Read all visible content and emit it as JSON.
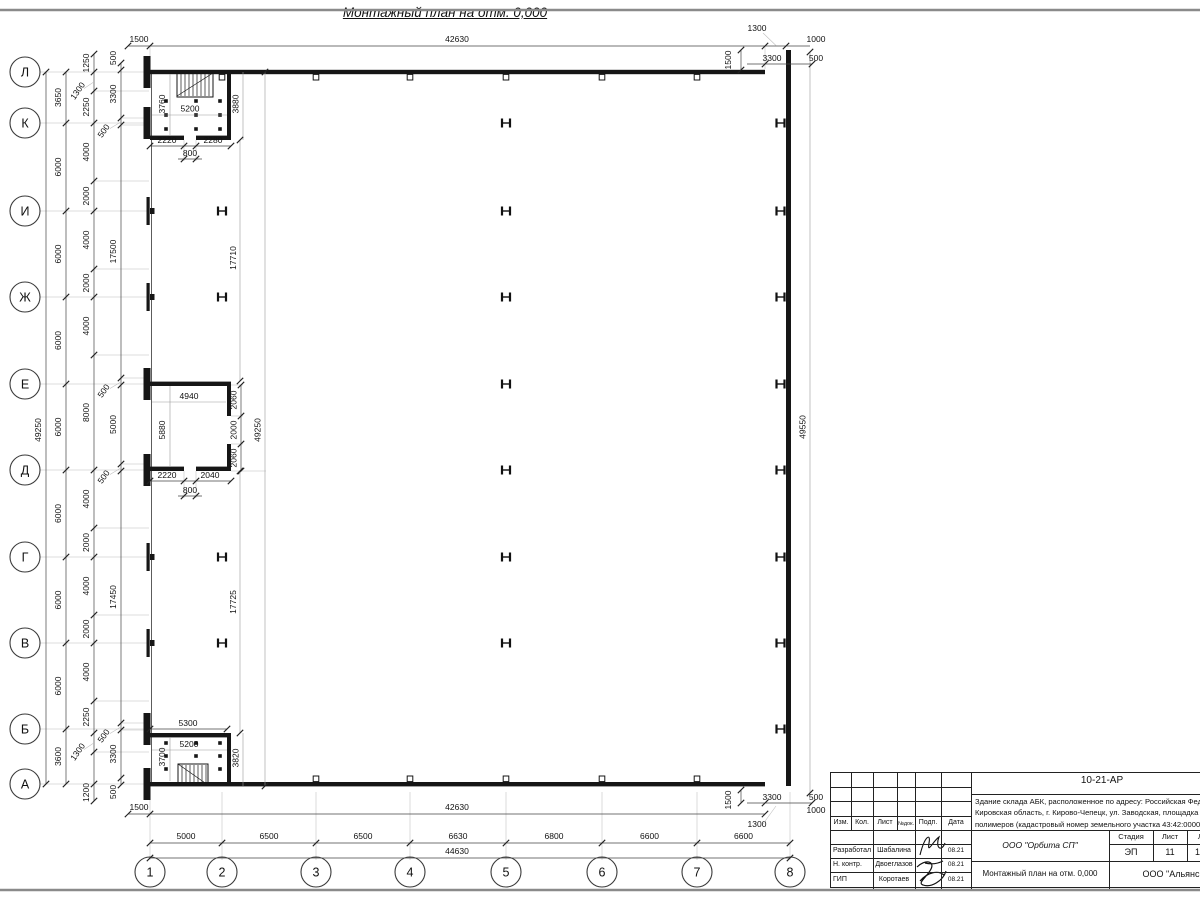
{
  "sheet": {
    "title": "Монтажный план на отм. 0,000"
  },
  "axes": {
    "rows": [
      "Л",
      "К",
      "И",
      "Ж",
      "Е",
      "Д",
      "Г",
      "В",
      "Б",
      "А"
    ],
    "cols": [
      "1",
      "2",
      "3",
      "4",
      "5",
      "6",
      "7",
      "8"
    ]
  },
  "dims": {
    "col_spans": [
      "5000",
      "6500",
      "6500",
      "6630",
      "6800",
      "6600",
      "6600"
    ],
    "col_total": "44630",
    "top_left": "1500",
    "top_span": "42630",
    "top_right_1300": "1300",
    "top_right_1000": "1000",
    "top_right_1500": "1500",
    "top_right_3300": "3300",
    "top_right_500": "500",
    "bot_left": "1500",
    "bot_span": "42630",
    "bot_right_3300": "3300",
    "bot_right_500": "500",
    "bot_right_1000": "1000",
    "bot_right_1300": "1300",
    "bot_right_1500": "1500",
    "row_chain1": [
      "3650",
      "6000",
      "6000",
      "6000",
      "6000",
      "6000",
      "6000",
      "6000",
      "3600"
    ],
    "row_total": "49250",
    "row_chain2": [
      "1250",
      "1300",
      "2250",
      "4000",
      "2000",
      "4000",
      "2000",
      "4000",
      "8000",
      "4000",
      "2000",
      "4000",
      "2000",
      "4000",
      "2250",
      "1300",
      "1200"
    ],
    "row_chain3": [
      "500",
      "3300",
      "500",
      "17500",
      "500",
      "5000",
      "500",
      "17450",
      "500",
      "3300",
      "500"
    ],
    "inner_upper": "17710",
    "inner_lower": "17725",
    "inner_total": "49250",
    "right_total": "49550"
  },
  "rooms": {
    "top": {
      "w": "5200",
      "hl": "3760",
      "hr": "3880",
      "b1": "2220",
      "b2": "2280",
      "door": "800"
    },
    "mid": {
      "w": "4940",
      "h": "5880",
      "r1": "2060",
      "r2": "2000",
      "r3": "2060",
      "b1": "2220",
      "b2": "2040",
      "door": "800"
    },
    "low": {
      "t": "5300",
      "w": "5200",
      "hl": "3700",
      "hr": "3820"
    }
  },
  "title_block": {
    "doc_number": "10-21-АР",
    "desc_lines": [
      "Здание склада АБК, расположенное по адресу: Российская Феде",
      "Кировская область, г. Кирово-Чепецк, ул. Заводская, площадка з",
      "полимеров (кадастровый номер земельного участка 43:42:0000"
    ],
    "header": {
      "izm": "Изм.",
      "kol": "Кол.",
      "list": "Лист",
      "ndok": "№док.",
      "podp": "Подп.",
      "data": "Дата"
    },
    "rows": [
      {
        "role": "Разработал",
        "name": "Шабалина",
        "date": "08.21"
      },
      {
        "role": "Н. контр.",
        "name": "Двоеглазов",
        "date": "08.21"
      },
      {
        "role": "ГИП",
        "name": "Коротаев",
        "date": "08.21"
      }
    ],
    "org": "ООО \"Орбита СП\"",
    "stage_label": "Стадия",
    "sheet_label": "Лист",
    "sheets_label": "Листов",
    "stage": "ЭП",
    "sheet": "11",
    "sheets": "1",
    "plan_name": "Монтажный план на отм. 0,000",
    "company": "ООО \"Альянс"
  }
}
